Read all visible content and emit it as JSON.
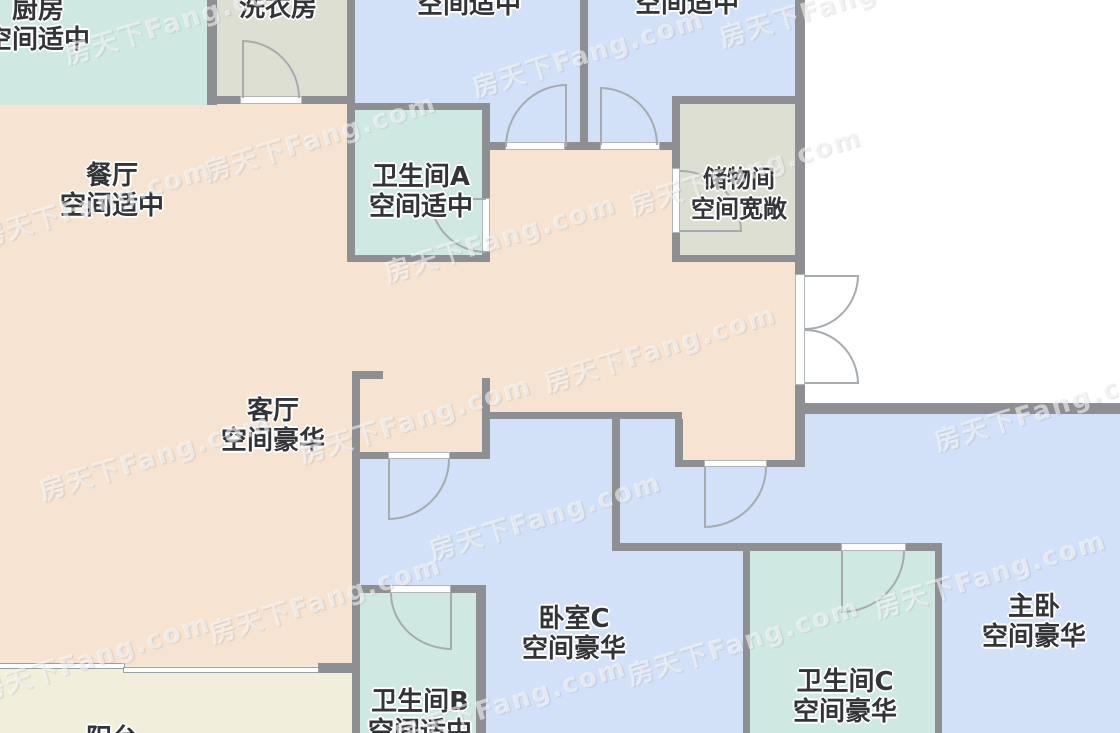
{
  "meta": {
    "width": 1120,
    "height": 733,
    "type": "apartment-floor-plan"
  },
  "palette": {
    "wall": "#8d8f92",
    "living_dining": "#f6e3d1",
    "bathroom_kitchen": "#cfe9e2",
    "utility": "#dddfd2",
    "bedroom": "#d2e0f8",
    "balcony": "#f1efdb",
    "outside": "#ffffff",
    "door_threshold": "#fdfdfd",
    "door_arc": "#a6abb0",
    "label_text": "#323437"
  },
  "rooms": [
    {
      "id": "kitchen",
      "name": "厨房",
      "space": "空间适中"
    },
    {
      "id": "laundry",
      "name": "洗衣房",
      "space": ""
    },
    {
      "id": "room-top-a",
      "name": "",
      "space": "空间适中"
    },
    {
      "id": "room-top-b",
      "name": "",
      "space": "空间适中"
    },
    {
      "id": "dining",
      "name": "餐厅",
      "space": "空间适中"
    },
    {
      "id": "bath-a",
      "name": "卫生间A",
      "space": "空间适中"
    },
    {
      "id": "storage",
      "name": "储物间",
      "space": "空间宽敞"
    },
    {
      "id": "living",
      "name": "客厅",
      "space": "空间豪华"
    },
    {
      "id": "bedroom-c",
      "name": "卧室C",
      "space": "空间豪华"
    },
    {
      "id": "master",
      "name": "主卧",
      "space": "空间豪华"
    },
    {
      "id": "bath-c",
      "name": "卫生间C",
      "space": "空间豪华"
    },
    {
      "id": "bath-b",
      "name": "卫生间B",
      "space": "空间适中"
    },
    {
      "id": "balcony",
      "name": "阳台",
      "space": ""
    }
  ],
  "watermark": {
    "text": "房天下Fang.com",
    "angle_deg": -17,
    "positions": [
      [
        180,
        19
      ],
      [
        500,
        237
      ],
      [
        835,
        2
      ],
      [
        588,
        52
      ],
      [
        320,
        136
      ],
      [
        745,
        170
      ],
      [
        95,
        202
      ],
      [
        660,
        347
      ],
      [
        415,
        418
      ],
      [
        155,
        455
      ],
      [
        545,
        515
      ],
      [
        990,
        573
      ],
      [
        325,
        598
      ],
      [
        94,
        656
      ],
      [
        743,
        640
      ],
      [
        510,
        700
      ],
      [
        1050,
        406
      ]
    ]
  }
}
